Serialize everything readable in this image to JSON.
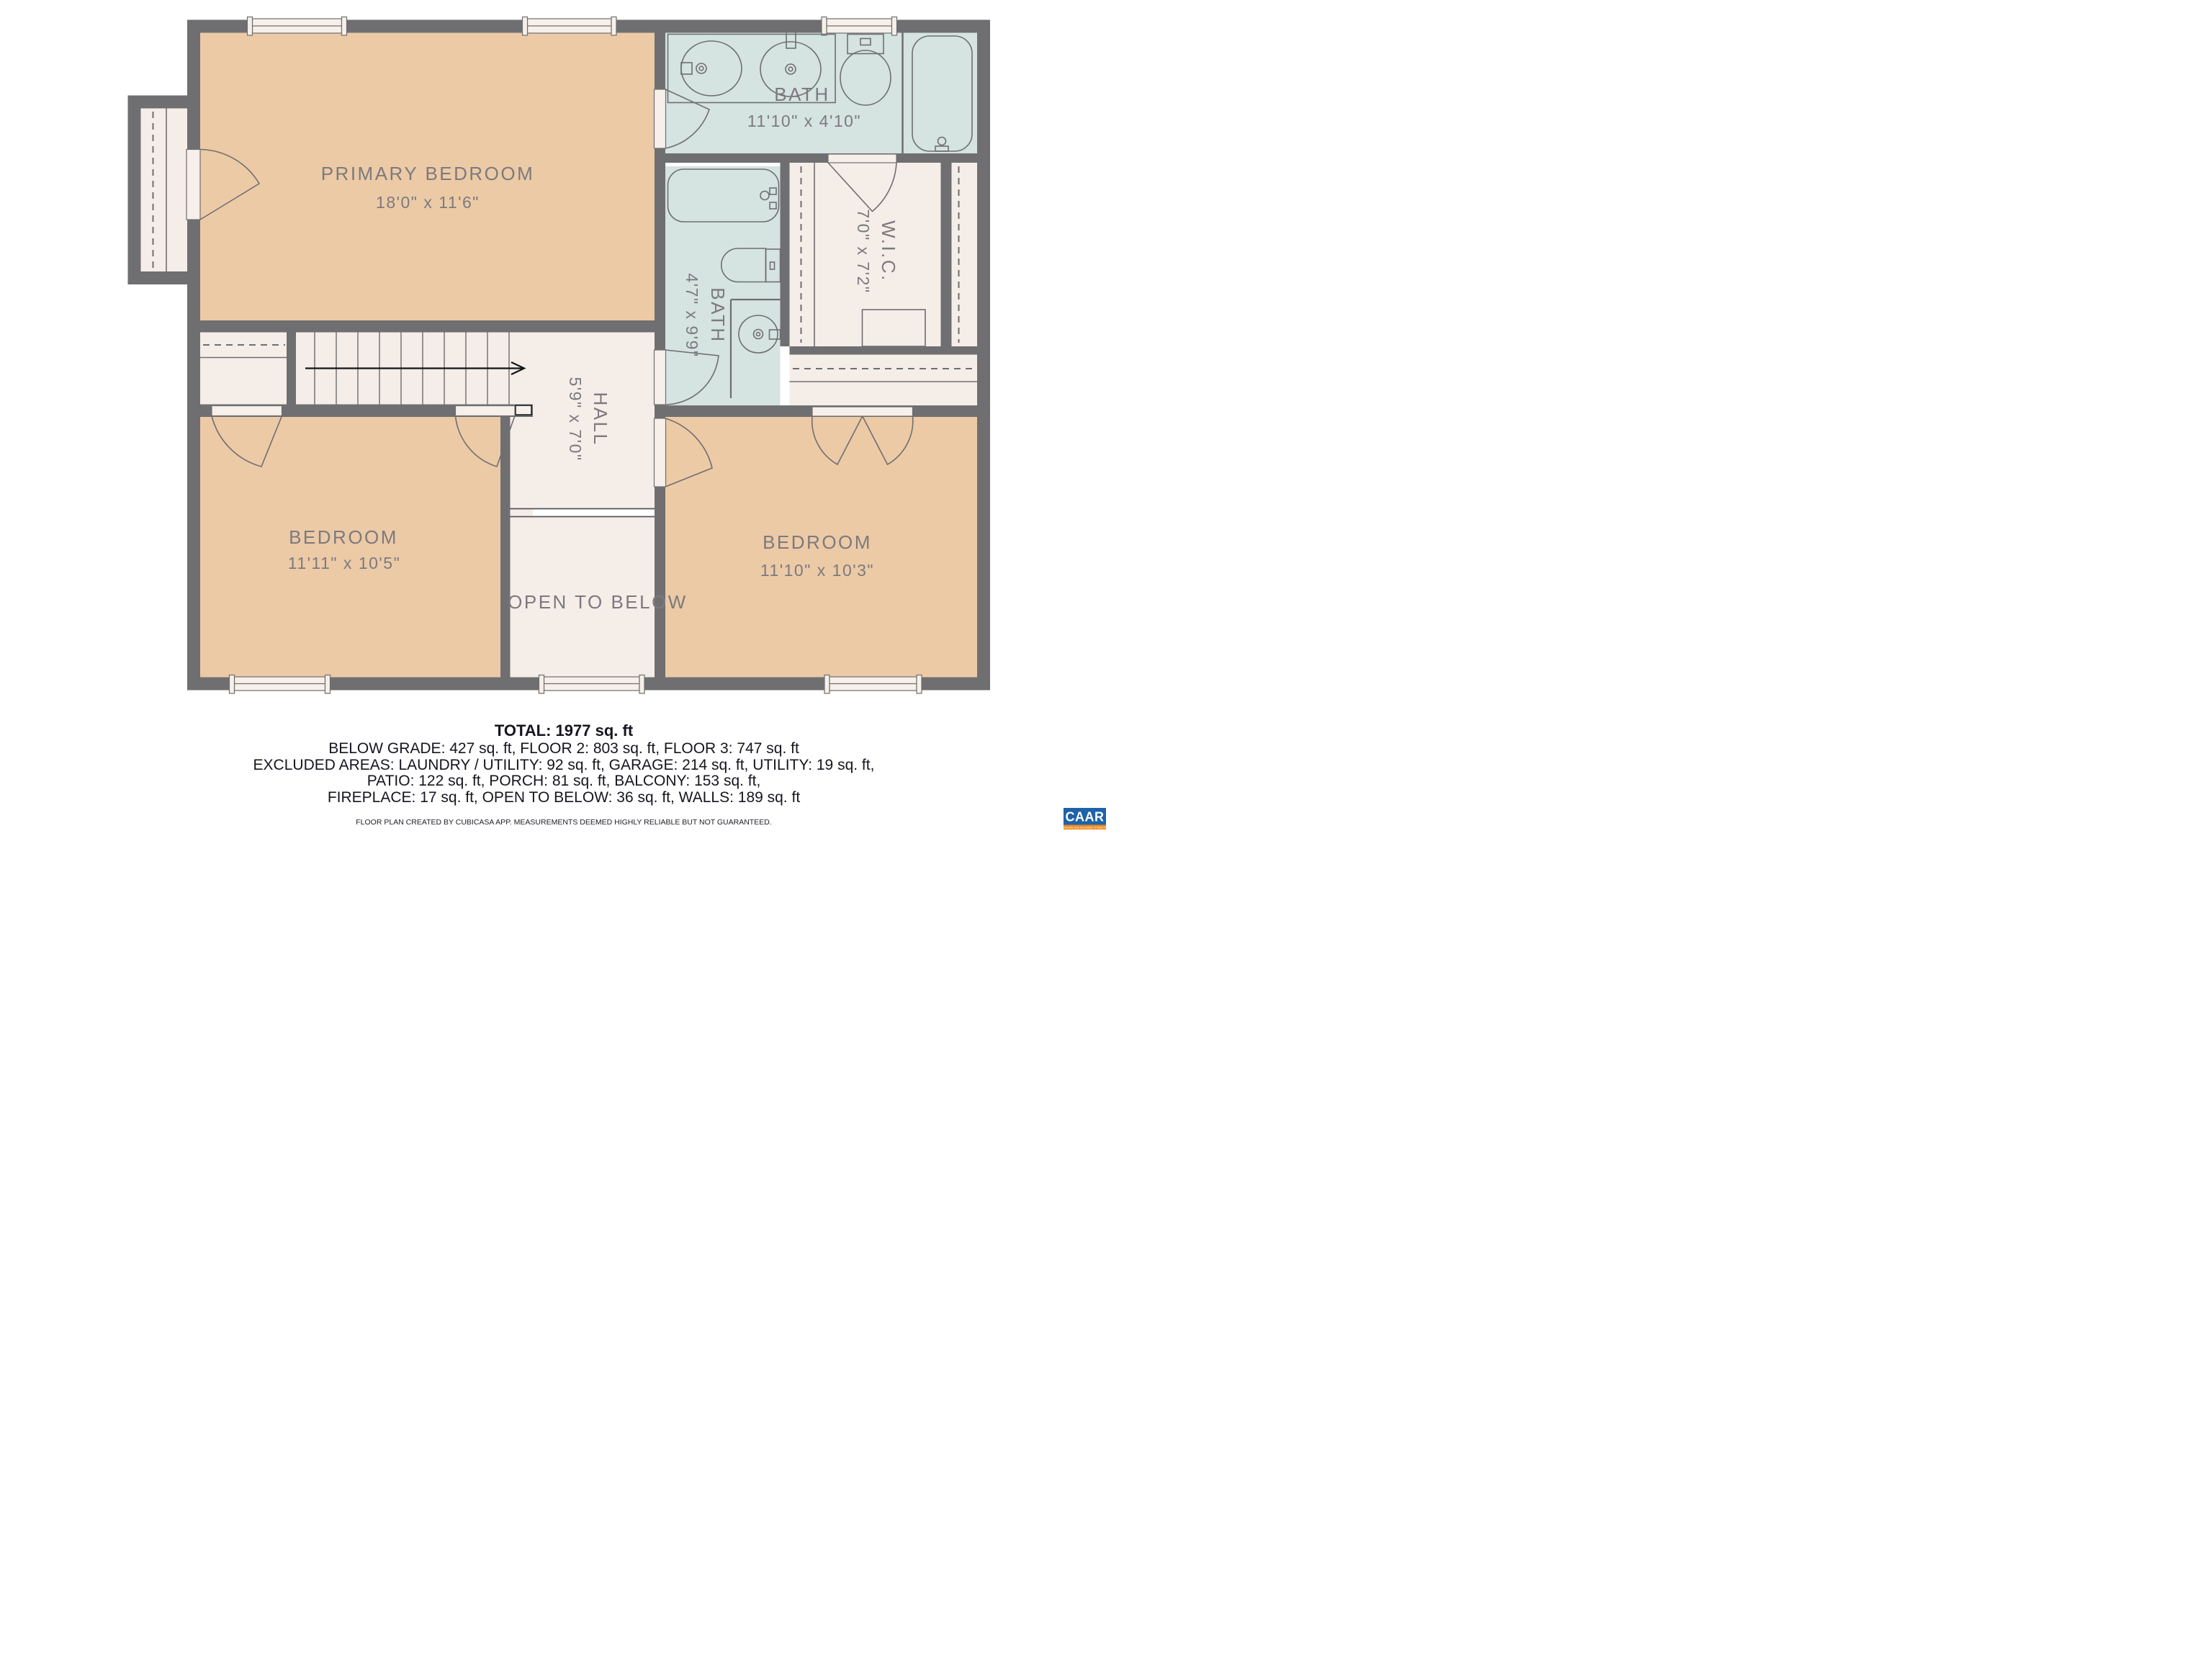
{
  "floor_plan": {
    "rooms": {
      "primary_bedroom": {
        "name": "PRIMARY BEDROOM",
        "dims": "18'0\" x 11'6\""
      },
      "bath_top": {
        "name": "BATH",
        "dims": "11'10\" x 4'10\""
      },
      "bath_mid": {
        "name": "BATH",
        "dims": "4'7\" x 9'9\""
      },
      "wic": {
        "name": "W.I.C.",
        "dims": "7'0\" x 7'2\""
      },
      "hall": {
        "name": "HALL",
        "dims": "5'9\" x 7'0\""
      },
      "bedroom_left": {
        "name": "BEDROOM",
        "dims": "11'11\" x 10'5\""
      },
      "bedroom_right": {
        "name": "BEDROOM",
        "dims": "11'10\" x 10'3\""
      },
      "open_to_below": {
        "name": "OPEN TO BELOW"
      }
    }
  },
  "summary": {
    "total": "TOTAL: 1977 sq. ft",
    "lines": [
      "BELOW GRADE: 427 sq. ft, FLOOR 2: 803 sq. ft, FLOOR 3: 747 sq. ft",
      "EXCLUDED AREAS: LAUNDRY / UTILITY: 92 sq. ft, GARAGE: 214 sq. ft, UTILITY: 19 sq. ft,",
      "PATIO: 122 sq. ft, PORCH: 81 sq. ft, BALCONY: 153 sq. ft,",
      "FIREPLACE: 17 sq. ft, OPEN TO BELOW: 36 sq. ft, WALLS: 189 sq. ft"
    ],
    "disclaimer": "FLOOR PLAN CREATED BY CUBICASA APP. MEASUREMENTS DEEMED HIGHLY RELIABLE BUT NOT GUARANTEED."
  },
  "logo": {
    "name": "CAAR",
    "tagline": "Charlottesville Area Association of REALTORS®"
  },
  "colors": {
    "wall": "#6f6f71",
    "room_tan": "#eccaa6",
    "room_blue": "#d5e3e1",
    "room_cream": "#f5ede8",
    "fixture_white": "#f7f0ea",
    "label_gray": "#7c7a7e",
    "logo_blue": "#1e63a9",
    "logo_orange": "#ee8a21"
  }
}
